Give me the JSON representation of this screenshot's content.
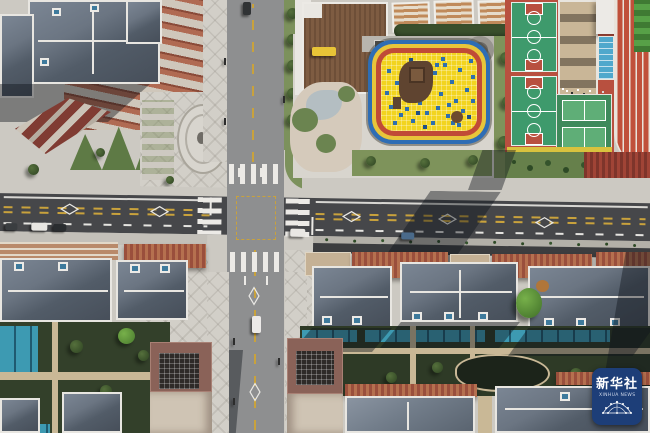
{
  "image": {
    "kind": "aerial-photograph",
    "subject": "Top-down drone view of a new residential neighborhood: a four-way road intersection, kindergarten play yard, school sports courts, slate-roofed apartment rows and landscaped courtyards",
    "width_px": 650,
    "height_px": 433
  },
  "watermark": {
    "agency_cn": "新华社",
    "agency_en": "XINHUA NEWS",
    "background": "#1d3e78",
    "text_color": "#ffffff",
    "position": "bottom-right"
  },
  "palette": {
    "asphalt": "#46474a",
    "concrete_street": "#8e8f90",
    "sidewalk": "#ccc9c2",
    "slate_roof": "#59626d",
    "slate_roof_light": "#7b8694",
    "terracotta": "#ab5f48",
    "playground_yellow": "#f2d41f",
    "playground_dot_blue": "#2f6fae",
    "ring_red": "#c04b37",
    "ring_yellow": "#e8c53a",
    "ring_blue": "#2e6db4",
    "court_green": "#3e9a6c",
    "court_red_base": "#b8503f",
    "field_green": "#4d8a3f",
    "pool_blue": "#4fa8cc",
    "lawn_green": "#7c915c",
    "courtyard_green": "#2e3a26",
    "water_aqua": "#3d9ab2",
    "maroon_roof": "#8a6258",
    "lane_yellow": "#c9a23c",
    "marking_white": "#ecebe8"
  },
  "scene": {
    "regions": [
      {
        "name": "intersection",
        "description": "Four-way junction with zebra crosswalks on all approaches and a dashed yellow junction box"
      },
      {
        "name": "north-south-street",
        "description": "Concrete street with dashed yellow center line running top to bottom"
      },
      {
        "name": "east-west-avenue",
        "description": "Dark asphalt avenue with double dashed yellow center lines, diamond markings and a planted median plus service lane on the east side"
      },
      {
        "name": "kindergarten-playground",
        "description": "Yellow rubber-tile play yard dotted with blue tiles, ringed by red, yellow and blue lanes",
        "colors": [
          "#f2d41f",
          "#2f6fae",
          "#c04b37",
          "#e8c53a",
          "#2e6db4"
        ]
      },
      {
        "name": "play-structure",
        "description": "Brown wooden climbing structure on the yellow yard",
        "color": "#5f4430"
      },
      {
        "name": "basketball-courts",
        "description": "Two green basketball courts with red keys on a red base",
        "colors": [
          "#3e9a6c",
          "#b8503f"
        ]
      },
      {
        "name": "volleyball-courts",
        "description": "Two small light-green courts beside the school building",
        "color": "#5fae77"
      },
      {
        "name": "swimming-pool",
        "description": "Small blue pool with lane lines",
        "color": "#4fa8cc"
      },
      {
        "name": "running-track",
        "description": "Red running track with white lane lines along the right edge",
        "color": "#c04b37"
      },
      {
        "name": "sports-field",
        "description": "Mown-stripe green field in the top-right corner",
        "color": "#4d8a3f"
      },
      {
        "name": "school-building",
        "description": "Tan school building with rows of dark windows",
        "color": "#c9b697"
      },
      {
        "name": "apartment-row",
        "description": "Tan apartment blocks with white roof edges along the top edge"
      },
      {
        "name": "slate-roof-houses",
        "description": "Rows of residential buildings with dark slate hip roofs, white ridge caps and blue skylight dormers",
        "color": "#59626d"
      },
      {
        "name": "terracotta-walls",
        "description": "Rows of terracotta brick walls and louvered roof strips",
        "color": "#ab5f48"
      },
      {
        "name": "courtyards",
        "description": "Landscaped courtyards with dark lawns, tan paths, trees, a kidney-shaped pond and aqua water/glass strips",
        "colors": [
          "#2e3a26",
          "#3d9ab2"
        ]
      },
      {
        "name": "plaza",
        "description": "Light paved plazas with an oval mosaic medallion, stepped planters, red diagonal ramps and zig-zag greenery"
      },
      {
        "name": "maroon-buildings",
        "description": "Maroon rooftop blocks with dark skylight grids flanking the south street",
        "color": "#8a6258"
      },
      {
        "name": "school-bus",
        "description": "Small yellow bus parked by the kindergarten building",
        "color": "#e8c437"
      }
    ],
    "road_markings": [
      "zebra crosswalks on all four approaches",
      "double dashed yellow center lines",
      "white dashed lane lines",
      "white diamond crosswalk-ahead symbols",
      "dashed yellow junction box",
      "white stop lines and straight arrows"
    ],
    "vehicles": [
      {
        "color": "white",
        "location": "southbound street below the intersection"
      },
      {
        "color": "white",
        "location": "parked on the west avenue"
      },
      {
        "color": "dark",
        "location": "parked on the west avenue"
      },
      {
        "color": "dark",
        "location": "parked at the west end of the avenue"
      },
      {
        "color": "dark-blue",
        "location": "east avenue service lane"
      },
      {
        "color": "white",
        "location": "east avenue near the intersection"
      },
      {
        "color": "dark",
        "location": "top of the north street"
      }
    ],
    "lighting": {
      "sun_direction": "upper-right",
      "shadows": "long building shadows fall toward the lower-left"
    }
  }
}
